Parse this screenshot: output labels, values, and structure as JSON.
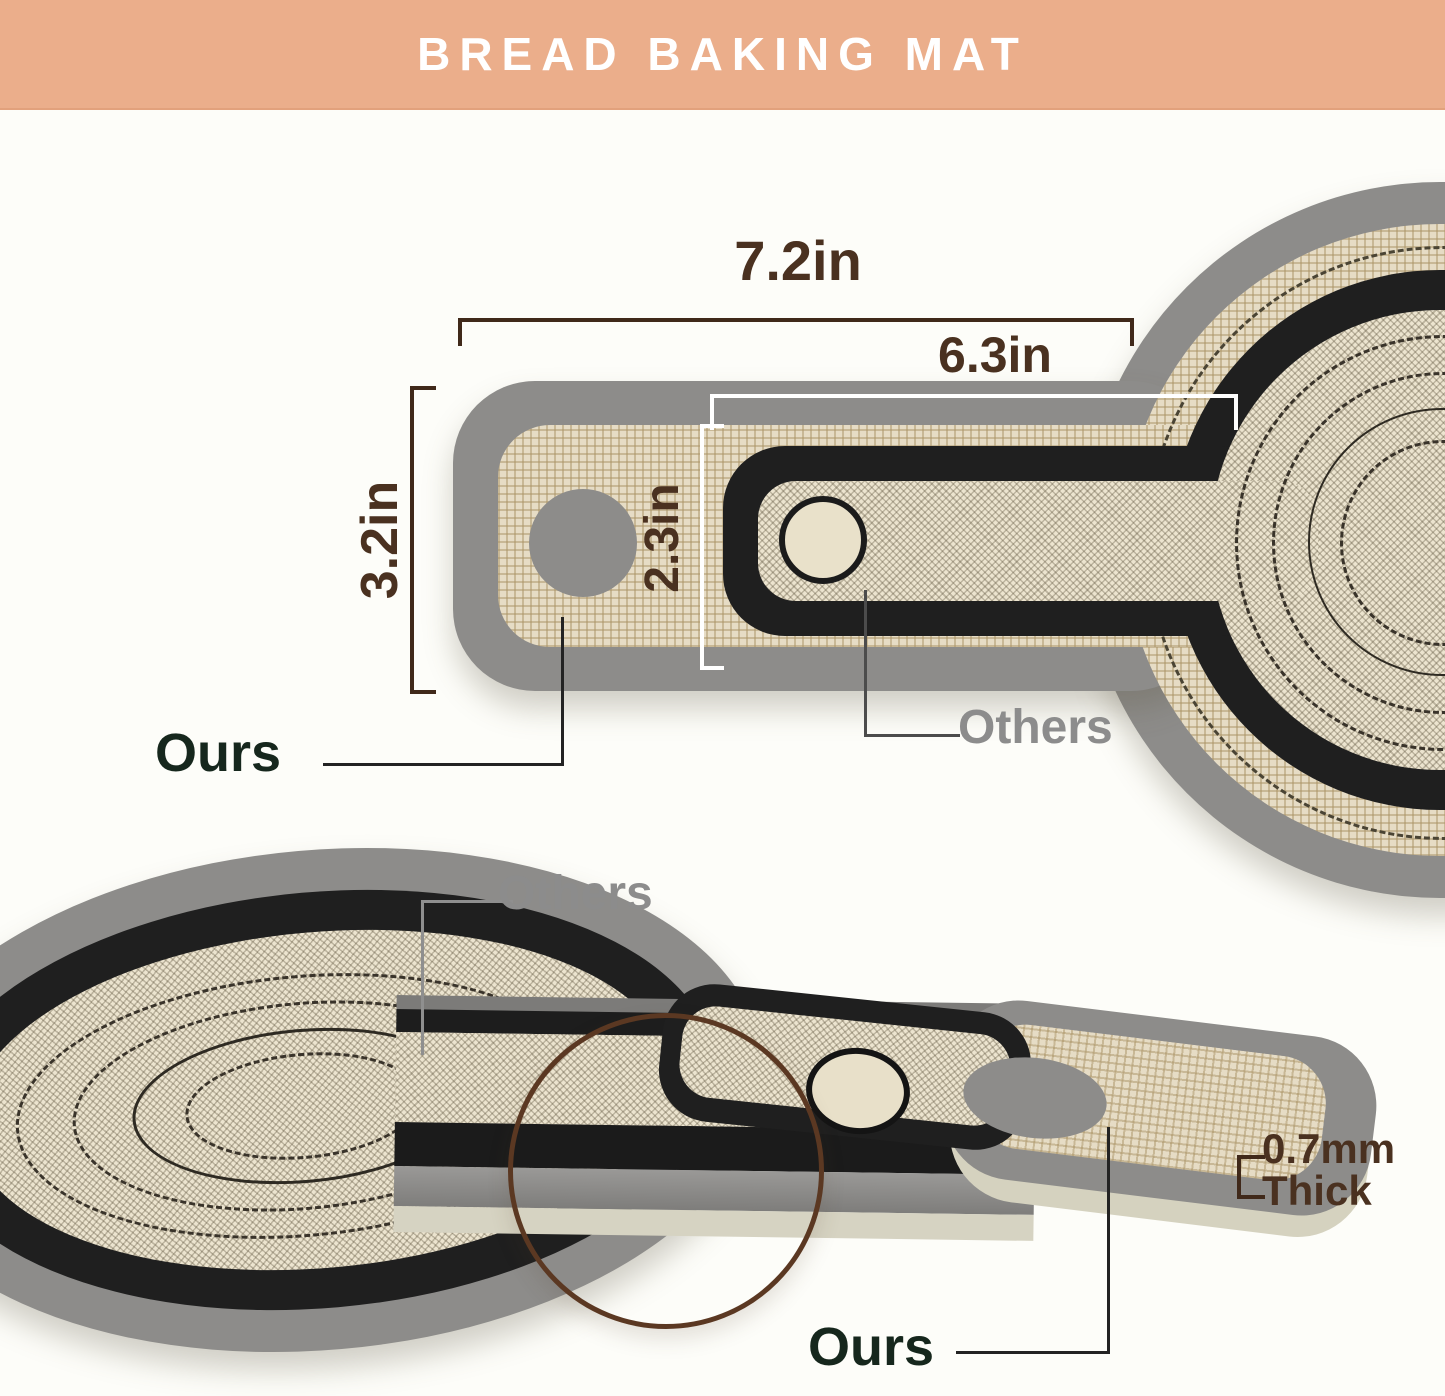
{
  "header": {
    "title": "BREAD BAKING MAT"
  },
  "top_view": {
    "dimensions": {
      "ours_width": "7.2in",
      "others_width": "6.3in",
      "ours_height": "3.2in",
      "others_height": "2.3in"
    },
    "labels": {
      "ours": "Ours",
      "others": "Others"
    }
  },
  "bottom_view": {
    "labels": {
      "ours": "Ours",
      "others": "Others"
    },
    "thickness": {
      "value": "0.7mm",
      "word": "Thick"
    }
  },
  "colors": {
    "header_bg": "#ebae8b",
    "header_text": "#ffffff",
    "dimension_text": "#4a3120",
    "bracket_brown": "#40291a",
    "bracket_white": "#ffffff",
    "ours_label": "#16271d",
    "others_label": "#8c8c8c",
    "mat_border_gray": "#8d8c8a",
    "mat_border_black": "#1f1f1f",
    "fabric_tan": "#e6dcc5",
    "fabric_cream": "#ece4cf",
    "magnifier_ring": "#5b3822",
    "thin_edge": "#d5d2bf"
  }
}
